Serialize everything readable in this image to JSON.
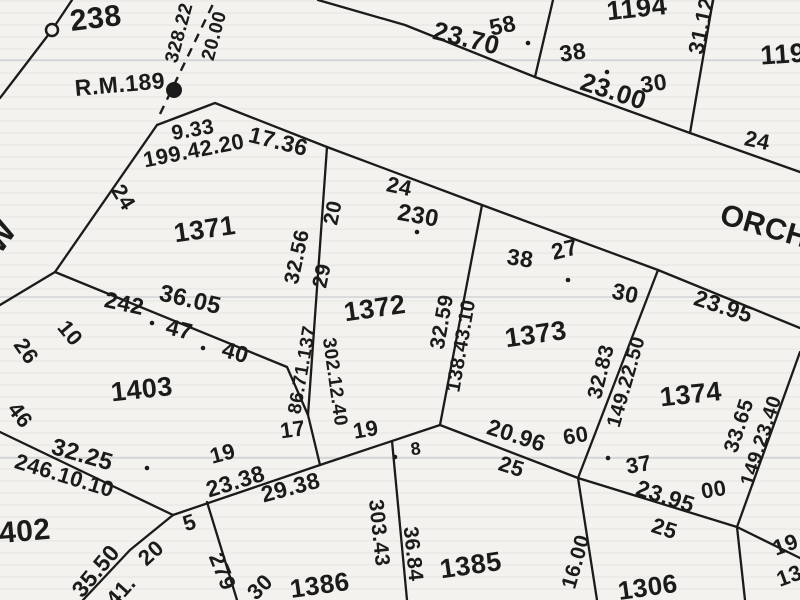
{
  "map": {
    "ink_color": "#1b1b1b",
    "paper_color": "#f3f2ee",
    "road_name": "ORCH",
    "reference_mark": "R.M.189",
    "lot_numbers_visible": [
      "238",
      "1194",
      "119",
      "1371",
      "1372",
      "1373",
      "1374",
      "1403",
      "402",
      "1385",
      "1386",
      "1306"
    ],
    "labels": [
      {
        "t": "238",
        "x": 96,
        "y": 20,
        "r": -7,
        "s": 30,
        "k": "lot"
      },
      {
        "t": "1194",
        "x": 637,
        "y": 10,
        "r": -6,
        "s": 27,
        "k": "lot"
      },
      {
        "t": "119",
        "x": 783,
        "y": 56,
        "r": -4,
        "s": 27,
        "k": "lot"
      },
      {
        "t": "1371",
        "x": 205,
        "y": 231,
        "r": -8,
        "s": 27,
        "k": "lot"
      },
      {
        "t": "1372",
        "x": 375,
        "y": 310,
        "r": -8,
        "s": 27,
        "k": "lot"
      },
      {
        "t": "1373",
        "x": 536,
        "y": 336,
        "r": -8,
        "s": 27,
        "k": "lot"
      },
      {
        "t": "1374",
        "x": 691,
        "y": 396,
        "r": -6,
        "s": 27,
        "k": "lot"
      },
      {
        "t": "1403",
        "x": 142,
        "y": 391,
        "r": -6,
        "s": 27,
        "k": "lot"
      },
      {
        "t": "402",
        "x": 25,
        "y": 533,
        "r": -5,
        "s": 30,
        "k": "lot"
      },
      {
        "t": "1385",
        "x": 471,
        "y": 567,
        "r": -8,
        "s": 27,
        "k": "lot"
      },
      {
        "t": "1386",
        "x": 320,
        "y": 587,
        "r": -8,
        "s": 26,
        "k": "lot"
      },
      {
        "t": "1306",
        "x": 648,
        "y": 589,
        "r": -8,
        "s": 26,
        "k": "lot"
      },
      {
        "t": "ORCH",
        "x": 764,
        "y": 228,
        "r": 16,
        "s": 30,
        "k": "road"
      },
      {
        "t": "R.M.189",
        "x": 120,
        "y": 86,
        "r": -5,
        "s": 23,
        "k": "bm"
      },
      {
        "t": "W",
        "x": 2,
        "y": 238,
        "r": -55,
        "s": 32,
        "k": "ltr"
      },
      {
        "t": "58",
        "x": 503,
        "y": 27,
        "r": -12,
        "s": 23,
        "k": "m"
      },
      {
        "t": "23.70",
        "x": 466,
        "y": 40,
        "r": 14,
        "s": 26,
        "k": "m"
      },
      {
        "t": "38",
        "x": 573,
        "y": 54,
        "r": -8,
        "s": 23,
        "k": "m"
      },
      {
        "t": "23.00",
        "x": 613,
        "y": 93,
        "r": 18,
        "s": 26,
        "k": "m"
      },
      {
        "t": "30",
        "x": 654,
        "y": 85,
        "r": -8,
        "s": 23,
        "k": "m"
      },
      {
        "t": "31.12",
        "x": 703,
        "y": 26,
        "r": -78,
        "s": 22,
        "k": "m"
      },
      {
        "t": "24",
        "x": 757,
        "y": 142,
        "r": 12,
        "s": 22,
        "k": "m"
      },
      {
        "t": "328.22",
        "x": 180,
        "y": 33,
        "r": -75,
        "s": 19,
        "k": "m"
      },
      {
        "t": "20.00",
        "x": 215,
        "y": 36,
        "r": -75,
        "s": 19,
        "k": "m"
      },
      {
        "t": "9.33",
        "x": 193,
        "y": 131,
        "r": -10,
        "s": 21,
        "k": "m"
      },
      {
        "t": "199.42.20",
        "x": 194,
        "y": 152,
        "r": -11,
        "s": 22,
        "k": "m"
      },
      {
        "t": "17.36",
        "x": 278,
        "y": 143,
        "r": 14,
        "s": 23,
        "k": "m"
      },
      {
        "t": "24",
        "x": 122,
        "y": 198,
        "r": 58,
        "s": 22,
        "k": "m"
      },
      {
        "t": "20",
        "x": 334,
        "y": 213,
        "r": -78,
        "s": 21,
        "k": "m"
      },
      {
        "t": "29",
        "x": 323,
        "y": 276,
        "r": -78,
        "s": 21,
        "k": "m"
      },
      {
        "t": "32.56",
        "x": 298,
        "y": 257,
        "r": -78,
        "s": 21,
        "k": "m"
      },
      {
        "t": "24",
        "x": 399,
        "y": 188,
        "r": 12,
        "s": 22,
        "k": "m"
      },
      {
        "t": "230",
        "x": 418,
        "y": 217,
        "r": 10,
        "s": 24,
        "k": "m"
      },
      {
        "t": "32.59",
        "x": 443,
        "y": 322,
        "r": -80,
        "s": 21,
        "k": "m"
      },
      {
        "t": "138.43.10",
        "x": 462,
        "y": 346,
        "r": -80,
        "s": 20,
        "k": "m"
      },
      {
        "t": "38",
        "x": 520,
        "y": 260,
        "r": 8,
        "s": 23,
        "k": "m"
      },
      {
        "t": "27",
        "x": 565,
        "y": 251,
        "r": -14,
        "s": 23,
        "k": "m"
      },
      {
        "t": "30",
        "x": 625,
        "y": 295,
        "r": 12,
        "s": 23,
        "k": "m"
      },
      {
        "t": "23.95",
        "x": 723,
        "y": 308,
        "r": 18,
        "s": 23,
        "k": "m"
      },
      {
        "t": "32.83",
        "x": 602,
        "y": 372,
        "r": -76,
        "s": 21,
        "k": "m"
      },
      {
        "t": "149.22.50",
        "x": 627,
        "y": 382,
        "r": -74,
        "s": 20,
        "k": "m"
      },
      {
        "t": "33.65",
        "x": 740,
        "y": 426,
        "r": -72,
        "s": 21,
        "k": "m"
      },
      {
        "t": "149.23.40",
        "x": 762,
        "y": 441,
        "r": -72,
        "s": 20,
        "k": "m"
      },
      {
        "t": "242",
        "x": 124,
        "y": 305,
        "r": 12,
        "s": 23,
        "k": "m"
      },
      {
        "t": "36.05",
        "x": 190,
        "y": 301,
        "r": 13,
        "s": 24,
        "k": "m"
      },
      {
        "t": "47",
        "x": 179,
        "y": 331,
        "r": 14,
        "s": 23,
        "k": "m"
      },
      {
        "t": "40",
        "x": 235,
        "y": 354,
        "r": 16,
        "s": 23,
        "k": "m"
      },
      {
        "t": "26",
        "x": 25,
        "y": 352,
        "r": 55,
        "s": 22,
        "k": "m"
      },
      {
        "t": "10",
        "x": 69,
        "y": 334,
        "r": 50,
        "s": 22,
        "k": "m"
      },
      {
        "t": "46",
        "x": 19,
        "y": 416,
        "r": 52,
        "s": 22,
        "k": "m"
      },
      {
        "t": "32.25",
        "x": 82,
        "y": 456,
        "r": 16,
        "s": 24,
        "k": "m"
      },
      {
        "t": "246.10.10",
        "x": 64,
        "y": 477,
        "r": 17,
        "s": 22,
        "k": "m"
      },
      {
        "t": "19",
        "x": 223,
        "y": 455,
        "r": -15,
        "s": 22,
        "k": "m"
      },
      {
        "t": "23.38",
        "x": 236,
        "y": 483,
        "r": -17,
        "s": 23,
        "k": "m"
      },
      {
        "t": "29.38",
        "x": 291,
        "y": 489,
        "r": -15,
        "s": 23,
        "k": "m"
      },
      {
        "t": "17",
        "x": 293,
        "y": 431,
        "r": -8,
        "s": 22,
        "k": "m"
      },
      {
        "t": "19",
        "x": 366,
        "y": 431,
        "r": -10,
        "s": 22,
        "k": "m"
      },
      {
        "t": "8",
        "x": 416,
        "y": 450,
        "r": -8,
        "s": 18,
        "k": "m"
      },
      {
        "t": "86.71.137",
        "x": 303,
        "y": 370,
        "r": -80,
        "s": 19,
        "k": "m"
      },
      {
        "t": "302.12.40",
        "x": 334,
        "y": 382,
        "r": 82,
        "s": 19,
        "k": "m"
      },
      {
        "t": "5",
        "x": 190,
        "y": 524,
        "r": -18,
        "s": 22,
        "k": "m"
      },
      {
        "t": "20",
        "x": 152,
        "y": 554,
        "r": -42,
        "s": 22,
        "k": "m"
      },
      {
        "t": "35.50",
        "x": 97,
        "y": 572,
        "r": -50,
        "s": 23,
        "k": "m"
      },
      {
        "t": "41.",
        "x": 122,
        "y": 592,
        "r": -48,
        "s": 22,
        "k": "m"
      },
      {
        "t": "279",
        "x": 221,
        "y": 572,
        "r": 68,
        "s": 22,
        "k": "m"
      },
      {
        "t": "30",
        "x": 261,
        "y": 588,
        "r": -45,
        "s": 22,
        "k": "m"
      },
      {
        "t": "303.43",
        "x": 378,
        "y": 533,
        "r": 84,
        "s": 21,
        "k": "m"
      },
      {
        "t": "36.84",
        "x": 412,
        "y": 554,
        "r": 84,
        "s": 21,
        "k": "m"
      },
      {
        "t": "20.96",
        "x": 516,
        "y": 437,
        "r": 18,
        "s": 23,
        "k": "m"
      },
      {
        "t": "25",
        "x": 511,
        "y": 468,
        "r": 18,
        "s": 22,
        "k": "m"
      },
      {
        "t": "60",
        "x": 576,
        "y": 437,
        "r": -10,
        "s": 22,
        "k": "m"
      },
      {
        "t": "37",
        "x": 639,
        "y": 466,
        "r": -10,
        "s": 22,
        "k": "m"
      },
      {
        "t": "00",
        "x": 714,
        "y": 491,
        "r": -10,
        "s": 22,
        "k": "m"
      },
      {
        "t": "23.95",
        "x": 665,
        "y": 498,
        "r": 18,
        "s": 23,
        "k": "m"
      },
      {
        "t": "25",
        "x": 664,
        "y": 530,
        "r": 18,
        "s": 22,
        "k": "m"
      },
      {
        "t": "16.00",
        "x": 577,
        "y": 562,
        "r": -74,
        "s": 21,
        "k": "m"
      },
      {
        "t": "19",
        "x": 786,
        "y": 546,
        "r": -20,
        "s": 22,
        "k": "m"
      },
      {
        "t": "13.",
        "x": 793,
        "y": 576,
        "r": -20,
        "s": 22,
        "k": "m"
      }
    ],
    "boundary_lines": [
      {
        "pts": [
          [
            72,
            0
          ],
          [
            52,
            30
          ],
          [
            0,
            98
          ]
        ]
      },
      {
        "pts": [
          [
            318,
            0
          ],
          [
            405,
            25
          ],
          [
            535,
            77
          ],
          [
            690,
            133
          ],
          [
            800,
            172
          ]
        ]
      },
      {
        "pts": [
          [
            535,
            77
          ],
          [
            553,
            0
          ]
        ]
      },
      {
        "pts": [
          [
            690,
            133
          ],
          [
            713,
            0
          ]
        ]
      },
      {
        "pts": [
          [
            157,
            125
          ],
          [
            215,
            103
          ],
          [
            327,
            147
          ],
          [
            482,
            205
          ],
          [
            658,
            270
          ],
          [
            800,
            328
          ]
        ]
      },
      {
        "pts": [
          [
            157,
            125
          ],
          [
            55,
            272
          ]
        ]
      },
      {
        "pts": [
          [
            55,
            272
          ],
          [
            0,
            305
          ]
        ]
      },
      {
        "pts": [
          [
            55,
            272
          ],
          [
            287,
            367
          ],
          [
            308,
            415
          ]
        ]
      },
      {
        "pts": [
          [
            327,
            147
          ],
          [
            308,
            415
          ]
        ]
      },
      {
        "pts": [
          [
            308,
            415
          ],
          [
            320,
            465
          ]
        ]
      },
      {
        "pts": [
          [
            0,
            432
          ],
          [
            173,
            515
          ]
        ]
      },
      {
        "pts": [
          [
            173,
            515
          ],
          [
            320,
            465
          ],
          [
            440,
            425
          ]
        ]
      },
      {
        "pts": [
          [
            173,
            515
          ],
          [
            130,
            550
          ],
          [
            83,
            600
          ]
        ]
      },
      {
        "pts": [
          [
            207,
            502
          ],
          [
            237,
            600
          ]
        ]
      },
      {
        "pts": [
          [
            440,
            425
          ],
          [
            482,
            205
          ]
        ]
      },
      {
        "pts": [
          [
            440,
            425
          ],
          [
            578,
            478
          ],
          [
            737,
            527
          ],
          [
            800,
            558
          ]
        ]
      },
      {
        "pts": [
          [
            658,
            270
          ],
          [
            578,
            478
          ]
        ]
      },
      {
        "pts": [
          [
            800,
            352
          ],
          [
            737,
            527
          ]
        ]
      },
      {
        "pts": [
          [
            737,
            527
          ],
          [
            745,
            600
          ]
        ]
      },
      {
        "pts": [
          [
            578,
            478
          ],
          [
            597,
            600
          ]
        ]
      },
      {
        "pts": [
          [
            392,
            441
          ],
          [
            407,
            600
          ]
        ]
      }
    ],
    "dashed_lines": [
      {
        "pts": [
          [
            160,
            114
          ],
          [
            214,
            2
          ]
        ]
      }
    ],
    "markers": {
      "open_circle": {
        "x": 52,
        "y": 30,
        "r": 6
      },
      "rm_dot": {
        "x": 174,
        "y": 90,
        "r": 8
      },
      "survey_dots": [
        [
          528,
          43
        ],
        [
          607,
          72
        ],
        [
          152,
          323
        ],
        [
          203,
          348
        ],
        [
          147,
          468
        ],
        [
          417,
          232
        ],
        [
          395,
          457
        ],
        [
          608,
          458
        ],
        [
          568,
          280
        ]
      ]
    }
  }
}
